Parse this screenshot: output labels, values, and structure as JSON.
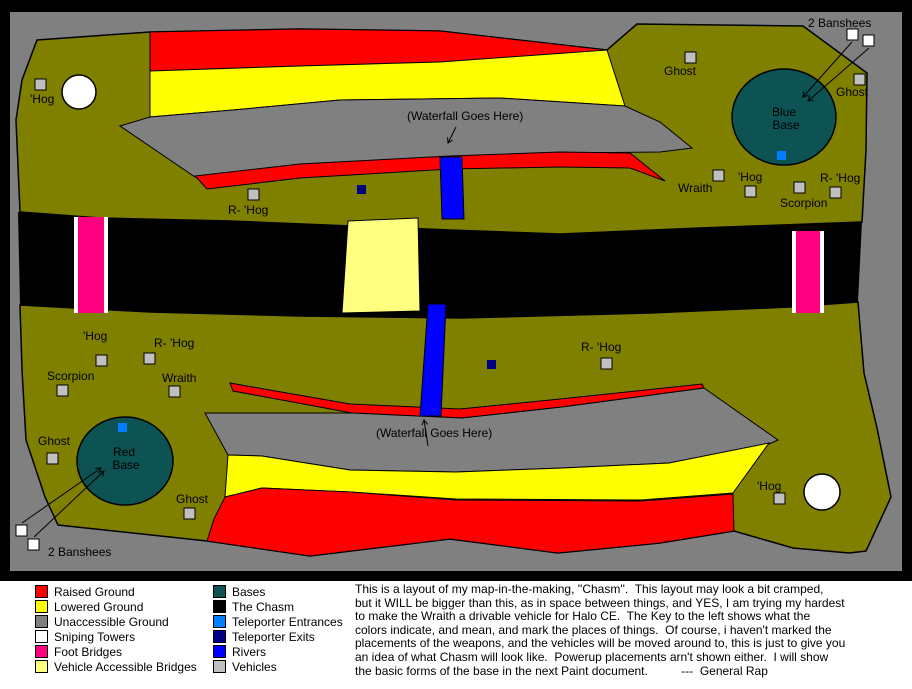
{
  "colors": {
    "border": "#000000",
    "background_gray": "#808080",
    "ground_olive": "#808000",
    "raised_red": "#ff0000",
    "lowered_yellow": "#ffff00",
    "unaccessible_gray": "#808080",
    "sniping_white": "#ffffff",
    "foot_bridge_pink": "#ff0080",
    "vehicle_bridge_pale": "#ffff80",
    "base_teal": "#0d5353",
    "chasm_black": "#000000",
    "teleporter_entrance_blue": "#0080ff",
    "teleporter_exit_navy": "#000080",
    "river_blue": "#0000ff",
    "vehicle_gray": "#c0c0c0"
  },
  "map": {
    "labels": [
      {
        "t": "'Hog",
        "x": 30,
        "y": 103
      },
      {
        "t": "R- 'Hog",
        "x": 228,
        "y": 214
      },
      {
        "t": "Ghost",
        "x": 664,
        "y": 75
      },
      {
        "t": "2 Banshees",
        "x": 808,
        "y": 27
      },
      {
        "t": "Ghost",
        "x": 836,
        "y": 96
      },
      {
        "t": "Wraith",
        "x": 678,
        "y": 192
      },
      {
        "t": "'Hog",
        "x": 738,
        "y": 181
      },
      {
        "t": "R- 'Hog",
        "x": 820,
        "y": 182
      },
      {
        "t": "Scorpion",
        "x": 780,
        "y": 207
      },
      {
        "t": "(Waterfall Goes Here)",
        "x": 407,
        "y": 120
      },
      {
        "t": "'Hog",
        "x": 83,
        "y": 340
      },
      {
        "t": "R- 'Hog",
        "x": 154,
        "y": 347
      },
      {
        "t": "Scorpion",
        "x": 47,
        "y": 380
      },
      {
        "t": "Wraith",
        "x": 162,
        "y": 382
      },
      {
        "t": "Ghost",
        "x": 38,
        "y": 445
      },
      {
        "t": "Ghost",
        "x": 176,
        "y": 503
      },
      {
        "t": "2 Banshees",
        "x": 48,
        "y": 556
      },
      {
        "t": "(Waterfall Goes Here)",
        "x": 376,
        "y": 437
      },
      {
        "t": "R- 'Hog",
        "x": 581,
        "y": 351
      },
      {
        "t": "'Hog",
        "x": 757,
        "y": 490
      },
      {
        "t": "Blue",
        "x": 784,
        "y": 116,
        "a": "middle"
      },
      {
        "t": "Base",
        "x": 786,
        "y": 129,
        "a": "middle"
      },
      {
        "t": "Red",
        "x": 124,
        "y": 456,
        "a": "middle"
      },
      {
        "t": "Base",
        "x": 126,
        "y": 469,
        "a": "middle"
      }
    ],
    "vehicles": [
      {
        "x": 40,
        "y": 84
      },
      {
        "x": 253,
        "y": 194
      },
      {
        "x": 690,
        "y": 57
      },
      {
        "x": 859,
        "y": 79
      },
      {
        "x": 718,
        "y": 175
      },
      {
        "x": 750,
        "y": 191
      },
      {
        "x": 799,
        "y": 187
      },
      {
        "x": 835,
        "y": 192
      },
      {
        "x": 101,
        "y": 360
      },
      {
        "x": 149,
        "y": 358
      },
      {
        "x": 62,
        "y": 390
      },
      {
        "x": 174,
        "y": 391
      },
      {
        "x": 606,
        "y": 363
      },
      {
        "x": 52,
        "y": 458
      },
      {
        "x": 189,
        "y": 513
      },
      {
        "x": 779,
        "y": 498
      }
    ],
    "banshee_markers": [
      {
        "x": 852,
        "y": 34
      },
      {
        "x": 868,
        "y": 40
      },
      {
        "x": 21,
        "y": 530
      },
      {
        "x": 33,
        "y": 544
      }
    ],
    "teleporter_entrances": [
      {
        "x": 781,
        "y": 155
      },
      {
        "x": 122,
        "y": 427
      }
    ],
    "teleporter_exits": [
      {
        "x": 361,
        "y": 189
      },
      {
        "x": 491,
        "y": 364
      }
    ]
  },
  "legend": {
    "left": [
      {
        "label": "Raised Ground",
        "color": "#ff0000"
      },
      {
        "label": "Lowered Ground",
        "color": "#ffff00"
      },
      {
        "label": "Unaccessible Ground",
        "color": "#808080"
      },
      {
        "label": "Sniping Towers",
        "color": "#ffffff"
      },
      {
        "label": "Foot Bridges",
        "color": "#ff0080"
      },
      {
        "label": "Vehicle Accessible Bridges",
        "color": "#ffff80"
      }
    ],
    "right": [
      {
        "label": "Bases",
        "color": "#0d5353"
      },
      {
        "label": "The Chasm",
        "color": "#000000"
      },
      {
        "label": "Teleporter Entrances",
        "color": "#0080ff"
      },
      {
        "label": "Teleporter Exits",
        "color": "#000080"
      },
      {
        "label": "Rivers",
        "color": "#0000ff"
      },
      {
        "label": "Vehicles",
        "color": "#c0c0c0"
      }
    ]
  },
  "description": {
    "lines": [
      "This is a layout of my map-in-the-making, ''Chasm''.  This layout may look a bit cramped,",
      "but it WILL be bigger than this, as in space between things, and YES, I am trying my hardest",
      "to make the Wraith a drivable vehicle for Halo CE.  The Key to the left shows what the",
      "colors indicate, and mean, and mark the places of things.  Of course, i haven't marked the",
      "placements of the weapons, and the vehicles will be moved around to, this is just to give you",
      "an idea of what Chasm will look like.  Powerup placements arn't shown either.  I will show",
      "the basic forms of the base in the next Paint document.          ---  General Rap"
    ]
  }
}
